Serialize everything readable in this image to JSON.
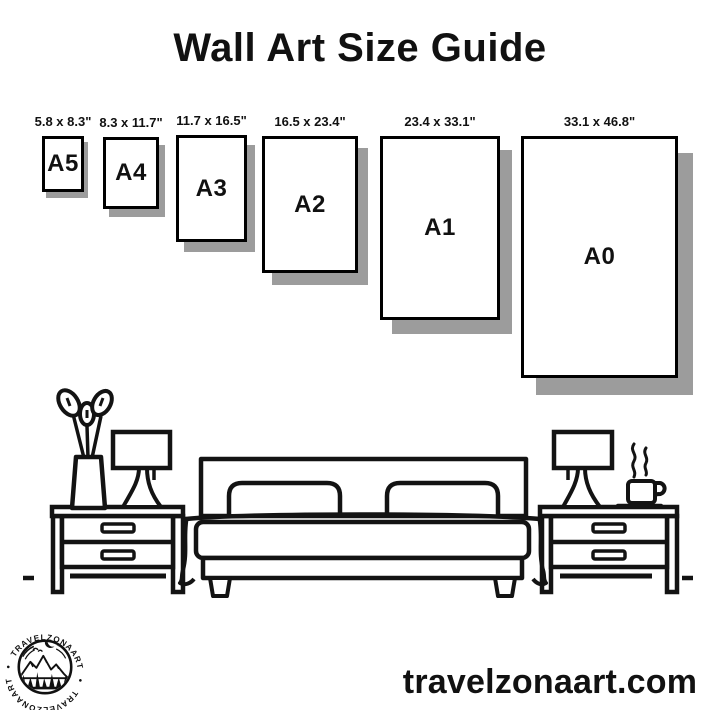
{
  "title": "Wall Art Size Guide",
  "sizes": [
    {
      "code": "A5",
      "dimensions": "5.8 x 8.3\""
    },
    {
      "code": "A4",
      "dimensions": "8.3 x 11.7\""
    },
    {
      "code": "A3",
      "dimensions": "11.7 x 16.5\""
    },
    {
      "code": "A2",
      "dimensions": "16.5 x 23.4\""
    },
    {
      "code": "A1",
      "dimensions": "23.4 x 33.1\""
    },
    {
      "code": "A0",
      "dimensions": "33.1 x 46.8\""
    }
  ],
  "logo": {
    "arc_text_top": "TRAVELZONAART",
    "arc_text_bottom": "TRAVELZONAART",
    "dot_left": "•",
    "dot_right": "•"
  },
  "footer": {
    "website": "travelzonaart.com"
  },
  "illustration": {
    "scene_name": "bedroom-line-art"
  },
  "colors": {
    "ink": "#131313",
    "shadow": "#9c9c9c",
    "background": "#ffffff"
  }
}
